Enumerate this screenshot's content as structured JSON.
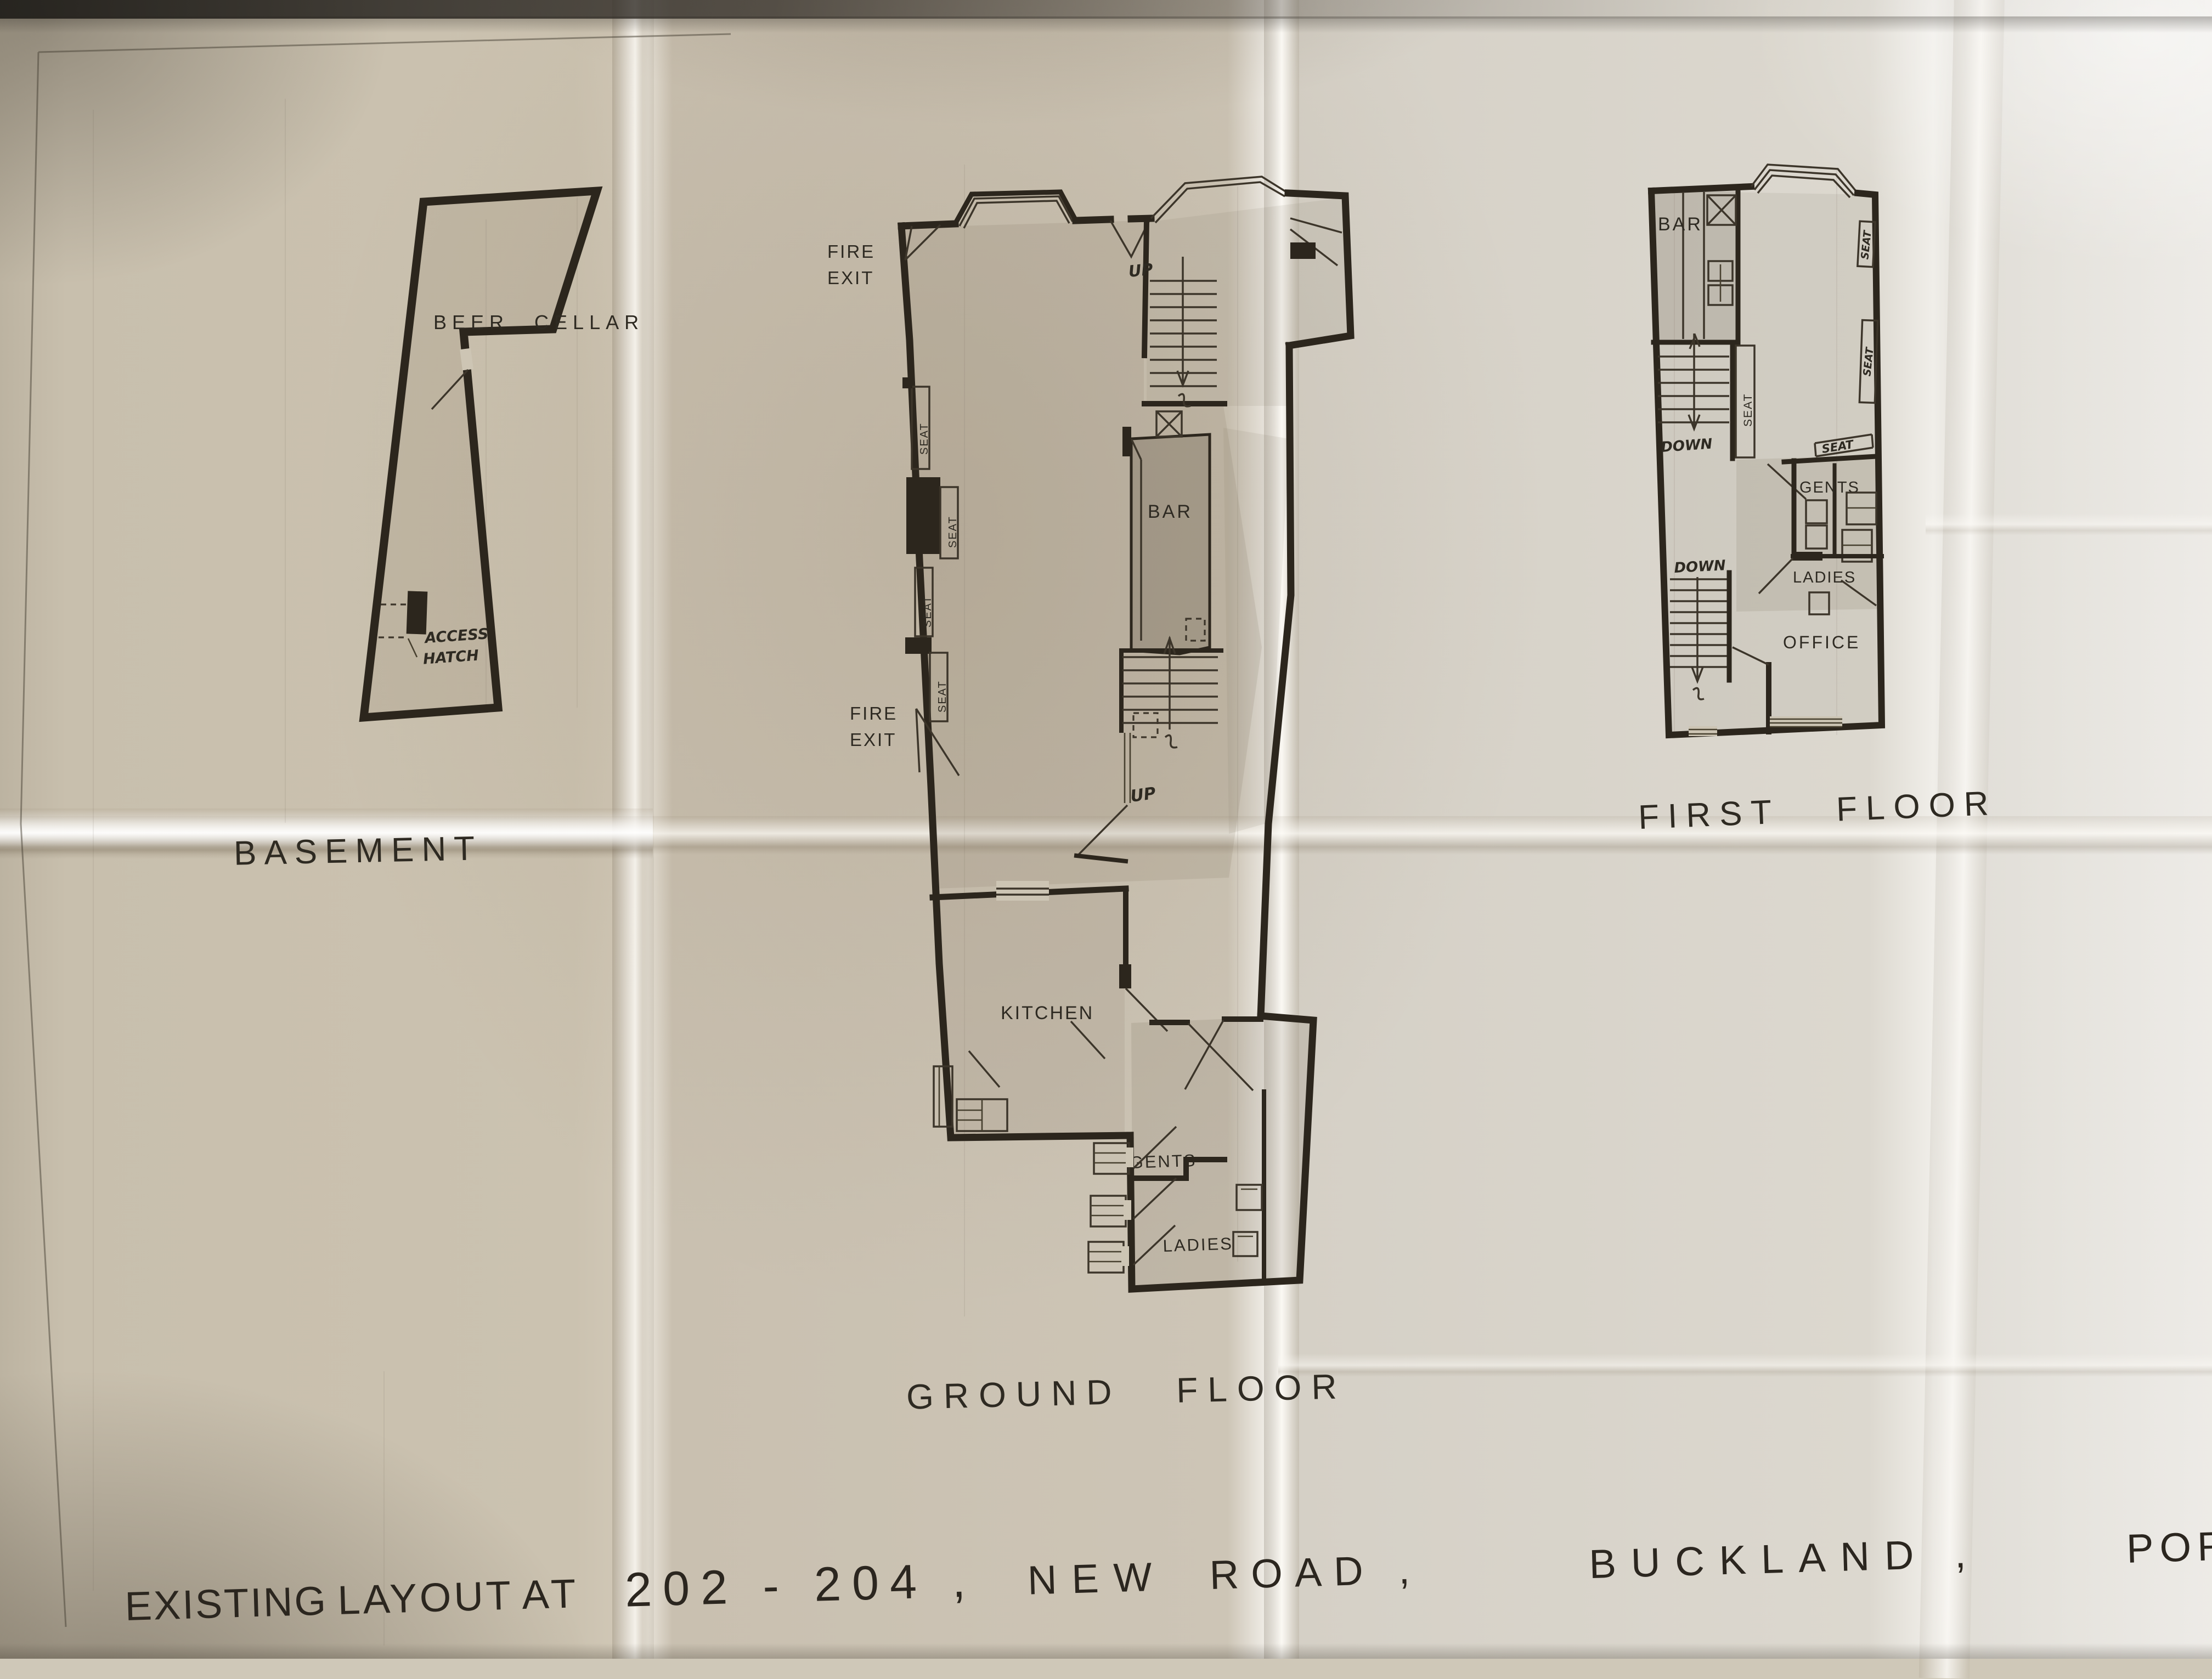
{
  "sheet": {
    "description_colors": {
      "ink": "#2c261d",
      "paper": "#cdc5b4"
    }
  },
  "plans": {
    "basement": {
      "title": "BASEMENT",
      "beer_cellar": "BEER CELLAR",
      "access": "ACCESS",
      "hatch": "HATCH"
    },
    "ground": {
      "title": "GROUND FLOOR",
      "fire1a": "FIRE",
      "fire1b": "EXIT",
      "fire2a": "FIRE",
      "fire2b": "EXIT",
      "up1": "UP",
      "up2": "UP",
      "seats": [
        "SEAT",
        "SEAT",
        "SEAT",
        "SEAT"
      ],
      "bar": "BAR",
      "kitchen": "KITCHEN",
      "gents": "GENTS",
      "ladies": "LADIES"
    },
    "first": {
      "title": "FIRST FLOOR",
      "bar": "BAR",
      "down1": "DOWN",
      "down2": "DOWN",
      "seat_corridor": "SEAT",
      "seat_right1": "SEAT",
      "seat_right2": "SEAT",
      "seat_bench": "SEAT",
      "gents": "GENTS",
      "ladies": "LADIES",
      "office": "OFFICE"
    }
  },
  "address": {
    "segments": [
      "EXISTING",
      "LAYOUT",
      "AT",
      "202 - 204 ,",
      "NEW",
      "ROAD ,",
      "BUCKLAND ,",
      "POR"
    ]
  }
}
